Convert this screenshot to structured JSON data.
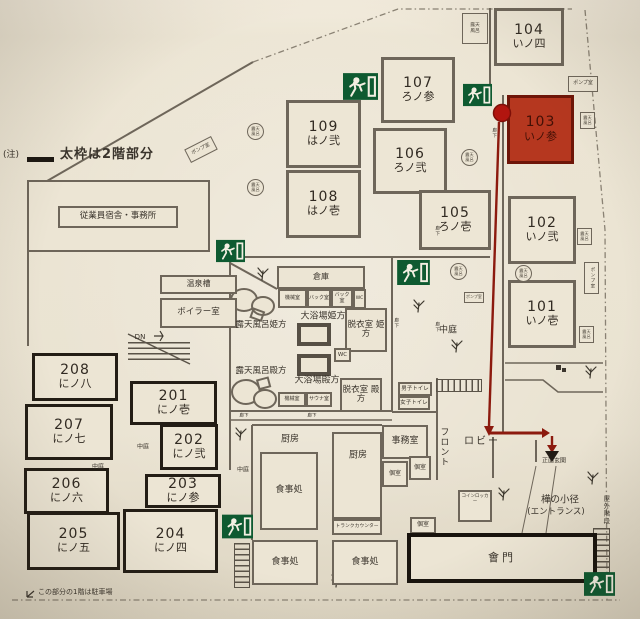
{
  "note": {
    "prefix": "(注)",
    "bold_line_label": "太枠は2階部分"
  },
  "parking_note": "この部分の1階は駐車場",
  "rooms": [
    {
      "number": "104",
      "name": "いノ四"
    },
    {
      "number": "107",
      "name": "ろノ参"
    },
    {
      "number": "103",
      "name": "いノ参"
    },
    {
      "number": "109",
      "name": "はノ弐"
    },
    {
      "number": "106",
      "name": "ろノ弐"
    },
    {
      "number": "108",
      "name": "はノ壱"
    },
    {
      "number": "105",
      "name": "ろノ壱"
    },
    {
      "number": "102",
      "name": "いノ弐"
    },
    {
      "number": "101",
      "name": "いノ壱"
    },
    {
      "number": "208",
      "name": "にノ八"
    },
    {
      "number": "201",
      "name": "にノ壱"
    },
    {
      "number": "207",
      "name": "にノ七"
    },
    {
      "number": "202",
      "name": "にノ弐"
    },
    {
      "number": "206",
      "name": "にノ六"
    },
    {
      "number": "203",
      "name": "にノ参"
    },
    {
      "number": "205",
      "name": "にノ五"
    },
    {
      "number": "204",
      "name": "にノ四"
    }
  ],
  "facilities": {
    "employee_office": "従業員宿舎・事務所",
    "onsen_tank": "温泉槽",
    "boiler_room": "ボイラー室",
    "dn": "DN",
    "warehouse": "倉庫",
    "machine_room": "機械室",
    "back_room": "バック室",
    "wc": "WC",
    "bath_hime": "大浴場姫方",
    "dressing_hime": "脱衣室\n姫方",
    "open_bath_hime": "露天風呂姫方",
    "open_bath_tono": "露天風呂殿方",
    "bath_tono": "大浴場殿方",
    "sauna": "サウナ室",
    "dressing_tono": "脱衣室\n殿方",
    "courtyard": "中庭",
    "mens_toilet": "男子トイレ",
    "womens_toilet": "女子トイレ",
    "front_desk": "フロント",
    "office": "事務室",
    "lobby": "ロビー",
    "main_entrance": "正面玄関",
    "entrance_path": "樺の小径",
    "entrance_path_sub": "(エントランス)",
    "kitchen": "厨房",
    "dining": "食事処",
    "trunk_counter": "トランクカウンター",
    "private_room": "個室",
    "coin_locker": "コインロッカー",
    "gate": "會門",
    "outdoor_stairs": "屋外階段",
    "corridor": "廊下",
    "pump_room": "ポンプ室",
    "open_air_bath_badge": "露天\n風呂"
  },
  "colors": {
    "highlight_room": "#b5371f",
    "route": "#8c1a0e",
    "exit_green": "#0e5a31",
    "paper": "#ebe4d3",
    "wall": "#6e665a",
    "bold_wall": "#1c1712"
  }
}
